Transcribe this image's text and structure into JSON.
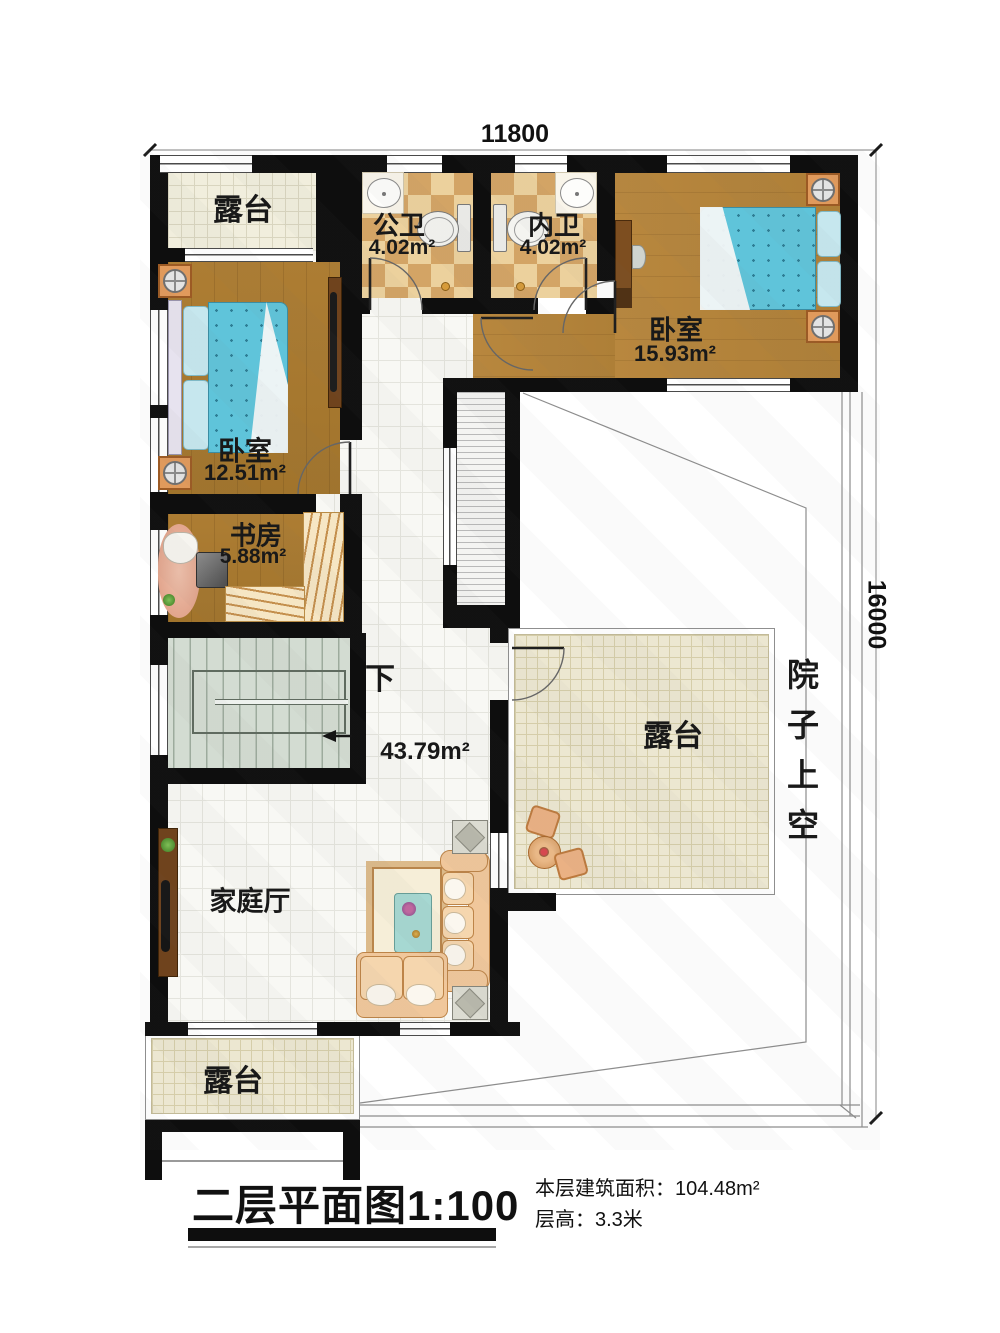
{
  "dimensions": {
    "width": "11800",
    "height": "16000"
  },
  "rooms": {
    "terrace_top": {
      "name": "露台"
    },
    "bath_public": {
      "name": "公卫",
      "area": "4.02m²"
    },
    "bath_inner": {
      "name": "内卫",
      "area": "4.02m²"
    },
    "bedroom_right": {
      "name": "卧室",
      "area": "15.93m²"
    },
    "bedroom_left": {
      "name": "卧室",
      "area": "12.51m²"
    },
    "study": {
      "name": "书房",
      "area": "5.88m²"
    },
    "hall": {
      "area": "43.79m²",
      "stairs_direction": "下"
    },
    "family_room": {
      "name": "家庭厅"
    },
    "terrace_mid": {
      "name": "露台"
    },
    "terrace_bottom": {
      "name": "露台"
    },
    "courtyard": {
      "name": "院子上空"
    }
  },
  "footer": {
    "title": "二层平面图1:100",
    "floor_area_label": "本层建筑面积：",
    "floor_area_value": "104.48m²",
    "floor_height_label": "层高：",
    "floor_height_value": "3.3米"
  }
}
